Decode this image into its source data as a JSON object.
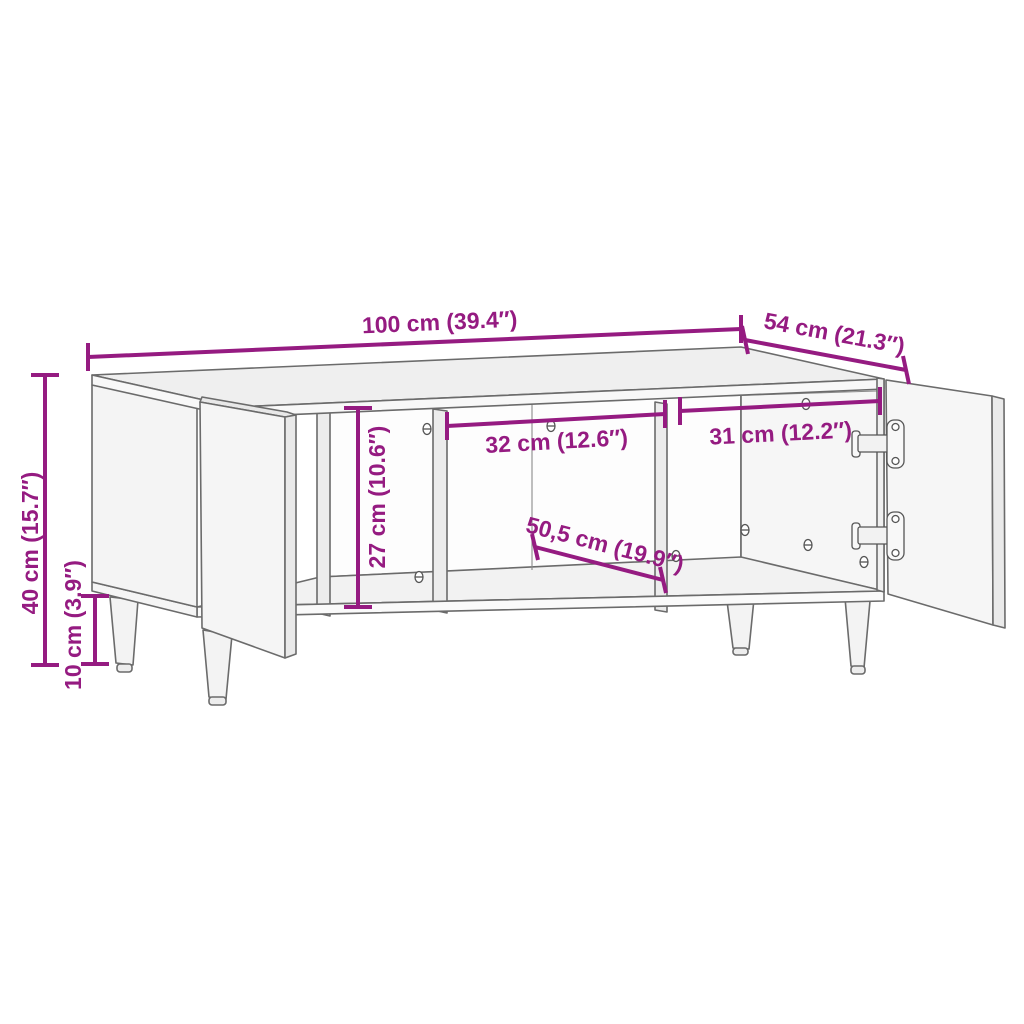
{
  "diagram": {
    "type": "furniture-dimension-line-drawing",
    "accent_color": "#951B81",
    "outline_color": "#6b6b6b",
    "dimensions": {
      "width": "100 cm (39.4″)",
      "depth": "54 cm (21.3″)",
      "height": "40 cm (15.7″)",
      "leg_height": "10 cm (3.9″)",
      "inner_height": "27 cm (10.6″)",
      "compartment_left_width": "32 cm (12.6″)",
      "compartment_right_width": "31 cm (12.2″)",
      "inner_depth": "50,5 cm (19.9″)"
    }
  }
}
